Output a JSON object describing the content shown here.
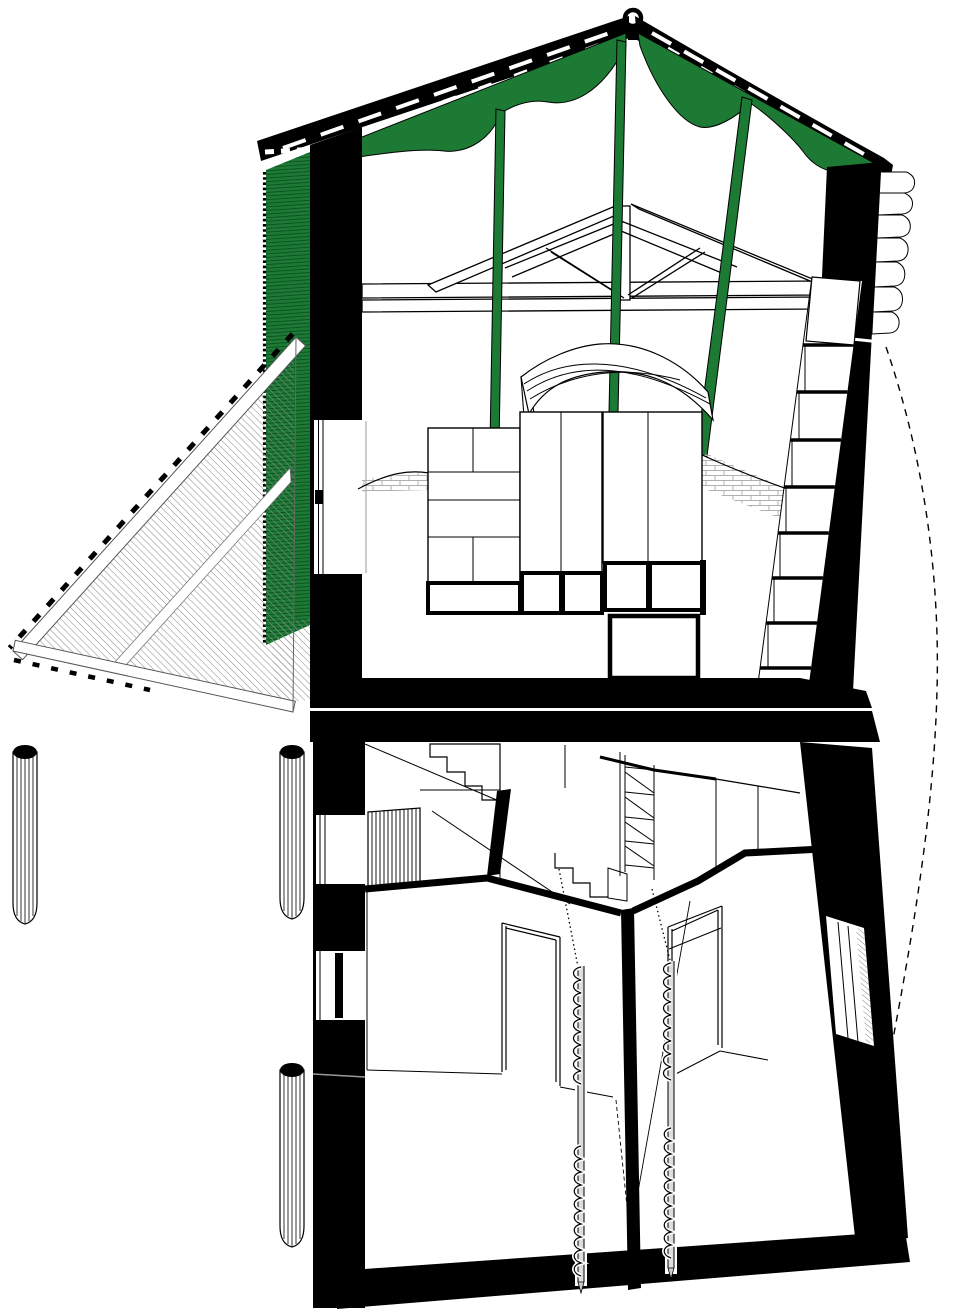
{
  "drawing": {
    "kind": "architectural-section-axonometric",
    "components": {
      "roof": "gabled-roof-with-lifting-ring",
      "membrane": "green-tension-membrane-with-straps",
      "gable_panel": "green-clad-gable-wall",
      "louver_triangle": "hatched-triangular-louver-panel",
      "truss": "king-post-timber-truss",
      "upper_furniture": "wardrobe-cabinets",
      "stair_upper": "stair-along-right-wall",
      "lower_rooms": "two-rooms-with-door-frames",
      "piles": "helical-ground-screws",
      "columns": "three-round-posts",
      "swing_arc": "dashed-swing-arc"
    }
  },
  "colors": {
    "membrane_green": "#1c7a34",
    "membrane_green_dark": "#0d5122",
    "ink": "#000000",
    "paper": "#ffffff",
    "hatch_gray": "#8f8f8f",
    "brick_gray": "#b0b0b0"
  }
}
